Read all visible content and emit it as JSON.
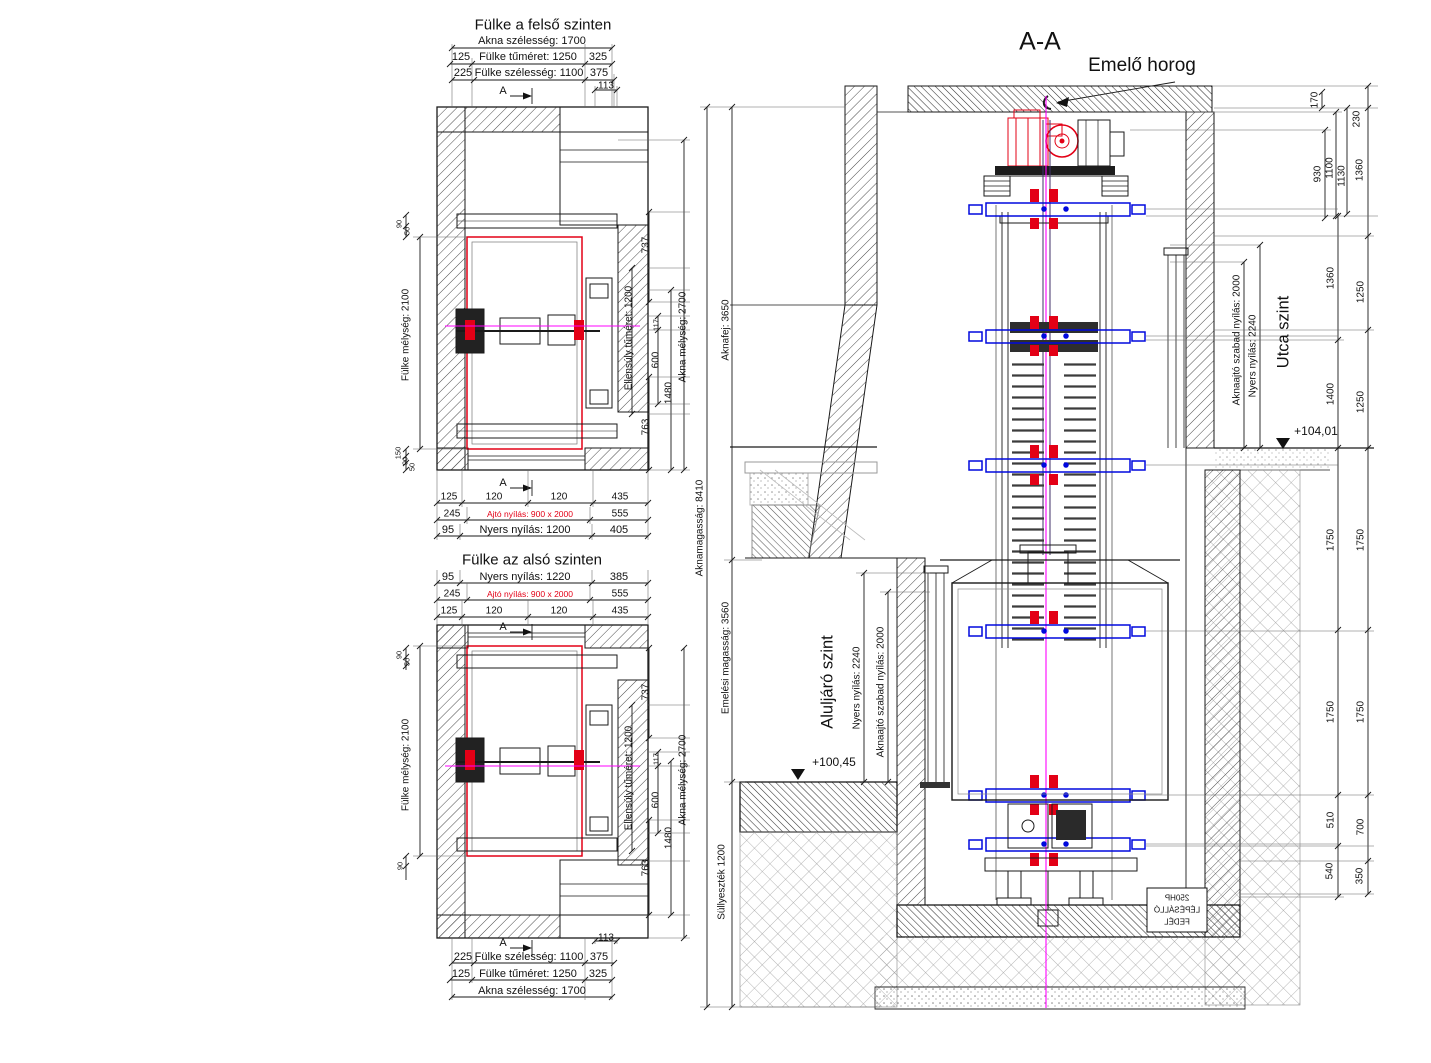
{
  "colors": {
    "red": "#e30016",
    "blue": "#0008dd",
    "magenta": "#ff00ff",
    "line": "#1a1a1a"
  },
  "plan_upper": {
    "title": "Fülke a felső szinten",
    "marker": "A",
    "top": {
      "akna": "Akna szélesség: 1700",
      "tumeret": [
        "125",
        "Fülke tűméret: 1250",
        "325"
      ],
      "szelesseg": [
        "225",
        "Fülke szélesség: 1100",
        "375"
      ],
      "d113": "113"
    },
    "bottom": {
      "cells": [
        "125",
        "120",
        "120",
        "435"
      ],
      "ajto": [
        "245",
        "Ajtó nyílás: 900 x 2000",
        "555"
      ],
      "nyers": [
        "95",
        "Nyers nyílás: 1200",
        "405"
      ]
    },
    "left": {
      "melyseg": "Fülke mélység: 2100",
      "top_small": [
        "90",
        "50"
      ],
      "bottom_small": [
        "150",
        "90",
        "50"
      ]
    },
    "right": {
      "d737": "737",
      "ellensuly": "Ellensúly tűméret: 1200",
      "d117": "117",
      "d600": "600",
      "d1480": "1480",
      "d763": "763",
      "akna_melyseg": "Akna mélység: 2700"
    }
  },
  "plan_lower": {
    "title": "Fülke az alsó szinten",
    "marker": "A",
    "top": {
      "nyers": [
        "95",
        "Nyers nyílás: 1220",
        "385"
      ],
      "ajto": [
        "245",
        "Ajtó nyílás: 900 x 2000",
        "555"
      ],
      "cells": [
        "125",
        "120",
        "120",
        "435"
      ]
    },
    "bottom": {
      "d113": "113",
      "szelesseg": [
        "225",
        "Fülke szélesség: 1100",
        "375"
      ],
      "tumeret": [
        "125",
        "Fülke tűméret: 1250",
        "325"
      ],
      "akna": "Akna szélesség: 1700"
    },
    "left": {
      "melyseg": "Fülke mélység: 2100",
      "top_small": [
        "90",
        "50"
      ],
      "bottom_small": [
        "90"
      ]
    },
    "right": {
      "d737": "737",
      "ellensuly": "Ellensúly tűméret: 1200",
      "d117": "117",
      "d600": "600",
      "d1480": "1480",
      "d763": "763",
      "akna_melyseg": "Akna mélység: 2700"
    }
  },
  "section": {
    "title": "A-A",
    "hook": "Emelő horog",
    "left": {
      "total": "Aknamagasság: 8410",
      "head": "Aknafej: 3650",
      "travel": "Emelési magasság: 3560",
      "pit": "Süllyeszték 1200"
    },
    "lower": {
      "level": "Aluljáró szint",
      "nyers": "Nyers nyílás: 2240",
      "ajto": "Aknaajtó szabad nyílás: 2000",
      "mark": "+100,45"
    },
    "upper": {
      "level": "Utca szint",
      "ajto": "Aknaajtó szabad nyílás: 2000",
      "nyers": "Nyers nyílás: 2240",
      "mark": "+104,01"
    },
    "right_dims": [
      "170",
      "230",
      "930",
      "1100",
      "1130",
      "1360",
      "1360",
      "1250",
      "1400",
      "1250",
      "1750",
      "1750",
      "1750",
      "1750",
      "510",
      "700",
      "540",
      "350"
    ],
    "mirror_label": [
      "250HP",
      "LÉPÉSÁLLÓ",
      "FEDÉL"
    ]
  }
}
